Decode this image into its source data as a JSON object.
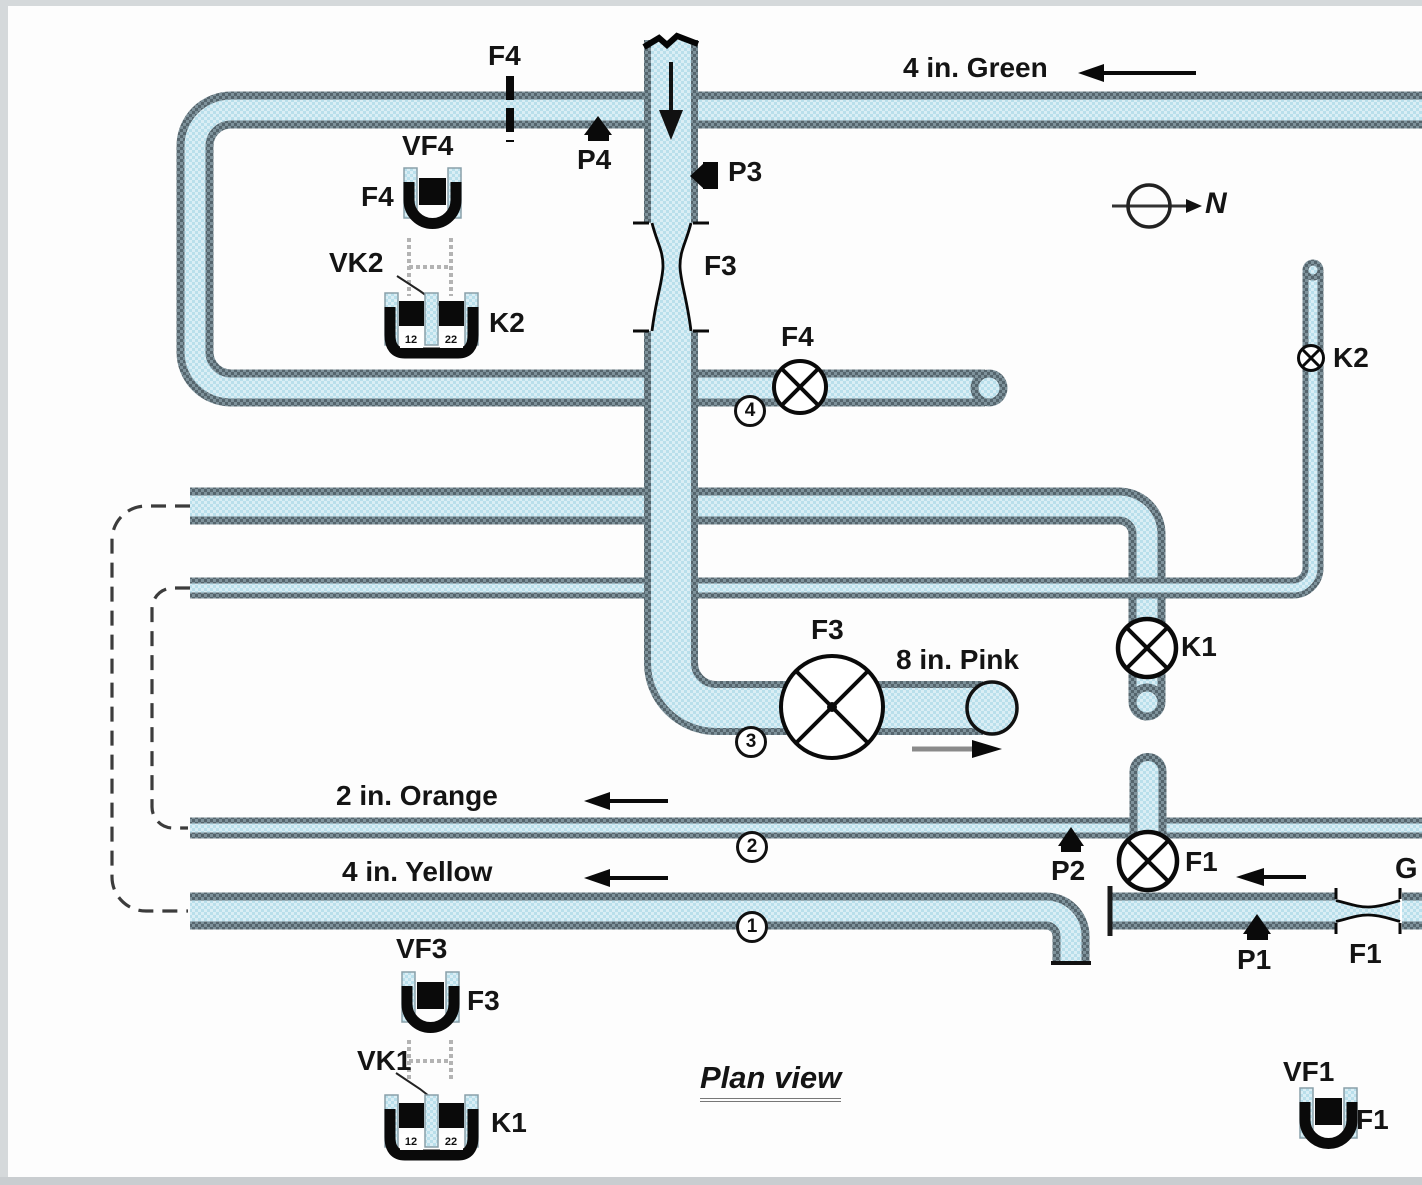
{
  "colors": {
    "pipe_fill": "#cfe9f2",
    "pipe_fill_alt": "#b9dfeb",
    "pipe_edge": "#55656d",
    "pipe_edge_alt": "#7e929b",
    "ink": "#141414"
  },
  "caption": {
    "text": "Plan view"
  },
  "compass": {
    "label": "N"
  },
  "pipes": {
    "green": {
      "label": "4 in. Green"
    },
    "orange": {
      "label": "2 in. Orange"
    },
    "yellow": {
      "label": "4 in. Yellow"
    },
    "pink": {
      "label": "8 in. Pink"
    },
    "gray": {
      "label_partial": "G"
    }
  },
  "stations": {
    "s1": "1",
    "s2": "2",
    "s3": "3",
    "s4": "4"
  },
  "pressure_taps": {
    "p1": "P1",
    "p2": "P2",
    "p3": "P3",
    "p4": "P4"
  },
  "valves": {
    "f1": "F1",
    "f3": "F3",
    "f4": "F4",
    "k1": "K1",
    "k2": "K2"
  },
  "flow_elements": {
    "f1": "F1",
    "f3": "F3",
    "f4_station": "F4"
  },
  "devices": {
    "vf4": {
      "title": "VF4",
      "label": "F4"
    },
    "vk2": {
      "title": "VK2",
      "label": "K2",
      "ch_left": "12",
      "ch_right": "22"
    },
    "vf3": {
      "title": "VF3",
      "label": "F3"
    },
    "vk1": {
      "title": "VK1",
      "label": "K1",
      "ch_left": "12",
      "ch_right": "22"
    },
    "vf1": {
      "title": "VF1",
      "label": "F1"
    }
  }
}
